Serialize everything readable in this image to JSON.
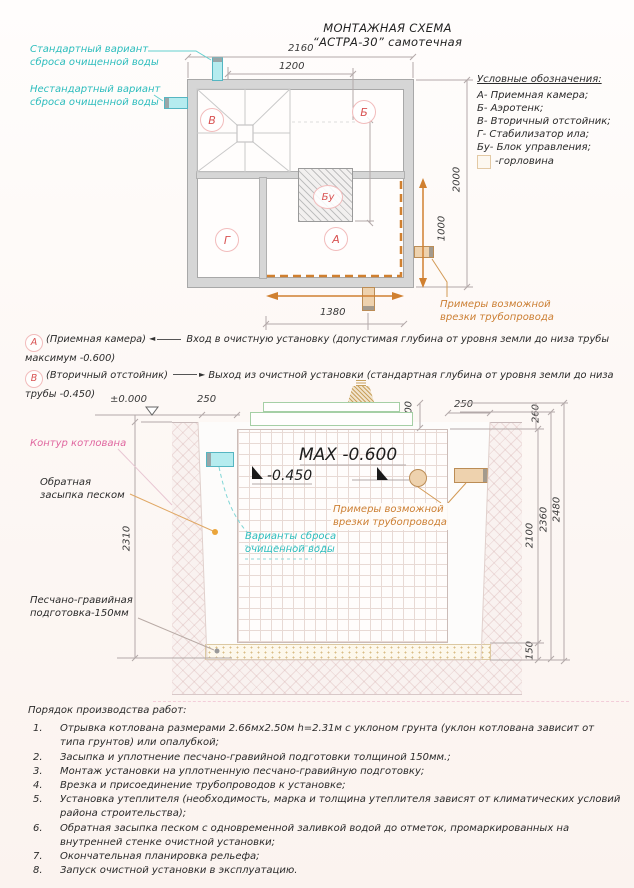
{
  "title": {
    "line1": "МОНТАЖНАЯ СХЕМА",
    "line2": "“АСТРА-30” самотечная"
  },
  "colors": {
    "teal": "#2dbdbd",
    "red": "#d85252",
    "orange": "#cc7f33",
    "pink": "#e0679f"
  },
  "plan": {
    "outfall_standard": "Стандартный вариант сброса очищенной воды",
    "outfall_nonstandard": "Нестандартный вариант сброса очищенной воды",
    "chambers": {
      "v": "В",
      "b": "Б",
      "g": "Г",
      "a": "А",
      "bu": "Бу"
    },
    "dims": {
      "outer_width": "2160",
      "inner_width": "1200",
      "mid_depth": "970",
      "outer_height": "2000",
      "inner_height": "1000",
      "bottom_width": "1380"
    },
    "tap_note": "Примеры возможной врезки трубопровода"
  },
  "legend": {
    "title": "Условные обозначения:",
    "items": [
      "А- Приемная камера;",
      "Б- Аэротенк;",
      "В- Вторичный отстойник;",
      "Г- Стабилизатор ила;",
      "Бу- Блок управления;"
    ],
    "neck_item": "-горловина"
  },
  "notes": [
    {
      "marker": "А",
      "chamber": "(Приемная камера)",
      "arrow": "◄",
      "text": "Вход в очистную установку (допустимая глубина от уровня земли до низа трубы максимум -0.600)"
    },
    {
      "marker": "В",
      "chamber": "(Вторичный отстойник)",
      "arrow": "►",
      "text": "Выход из очистной установки (стандартная глубина от уровня земли до низа трубы -0.450)"
    }
  ],
  "section": {
    "pit_contour": "Контур котлована",
    "backfill": "Обратная засыпка песком",
    "bedding": "Песчано-гравийная подготовка-150мм",
    "discharge_options": "Варианты сброса очищенной воды",
    "tap_note": "Примеры возможной врезки трубопровода",
    "levels": {
      "zero": "±0.000",
      "max": "MAX -0.600",
      "outlet": "-0.450"
    },
    "dims": {
      "left_250": "250",
      "cover_200": "200",
      "right_250": "250",
      "top_260": "260",
      "pit_2310": "2310",
      "tank_2100": "2100",
      "mid_2360": "2360",
      "total_2480": "2480",
      "bedding_150": "150"
    }
  },
  "procedure": {
    "title": "Порядок производства работ:",
    "items": [
      "Отрывка котлована размерами 2.66мх2.50м h=2.31м с уклоном грунта (уклон котлована зависит от типа грунтов) или опалубкой;",
      "Засыпка и уплотнение песчано-гравийной подготовки толщиной 150мм.;",
      "Монтаж установки на уплотненную песчано-гравийную подготовку;",
      "Врезка и присоединение трубопроводов к установке;",
      "Установка утеплителя (необходимость, марка и толщина утеплителя зависят от климатических условий района строительства);",
      "Обратная засыпка песком с одновременной заливкой водой до отметок, промаркированных на внутренней стенке очистной установки;",
      "Окончательная планировка рельефа;",
      "Запуск очистной установки в эксплуатацию."
    ]
  }
}
